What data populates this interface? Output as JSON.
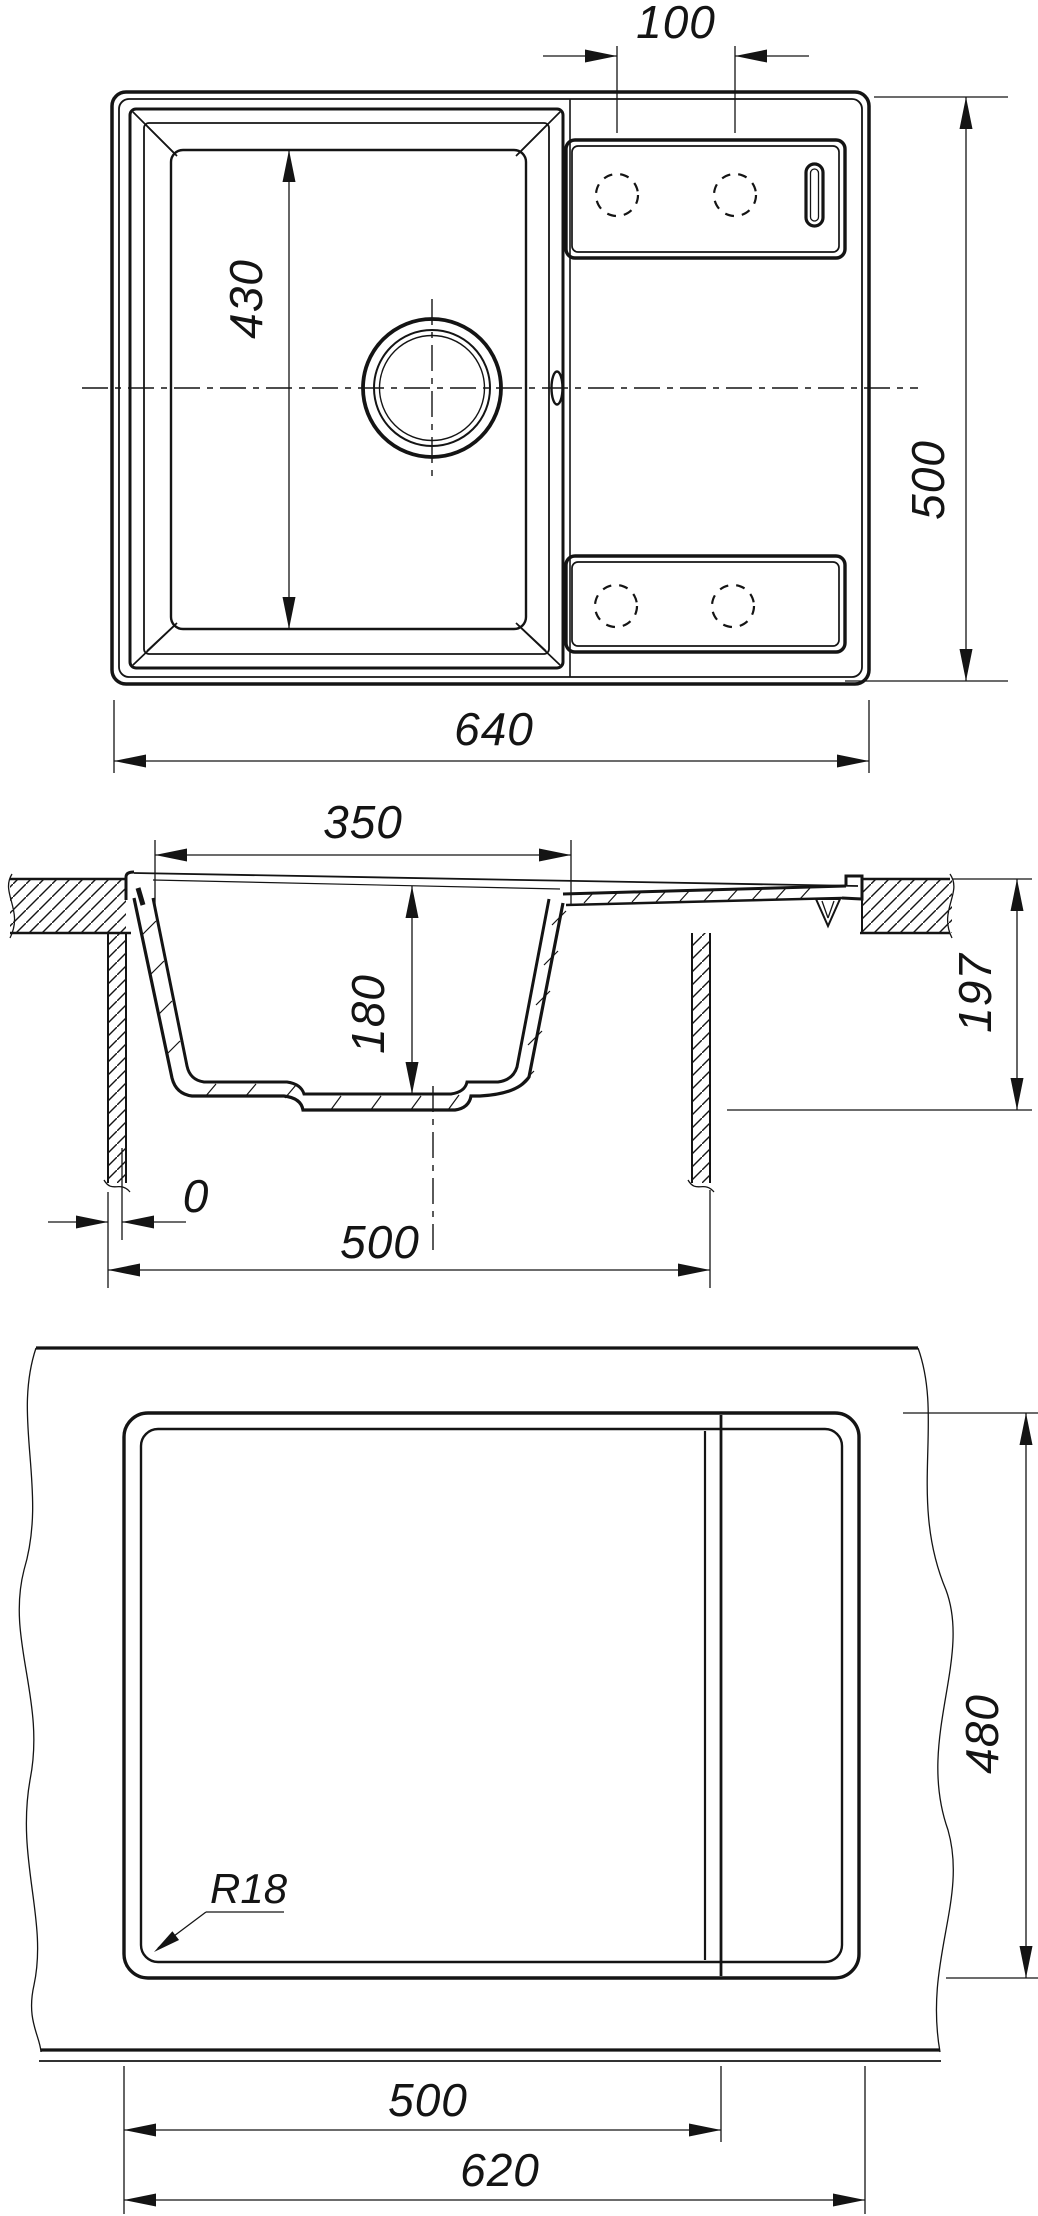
{
  "drawing": {
    "type": "technical-drawing",
    "subject": "kitchen sink with drainboard - dimensional drawing",
    "line_color": "#141414",
    "background": "#ffffff",
    "views": {
      "top": {
        "title": "top view",
        "dims": {
          "faucet_hole_spacing": "100",
          "overall_width": "640",
          "overall_depth": "500",
          "bowl_length": "430"
        }
      },
      "section": {
        "title": "cross section",
        "dims": {
          "bowl_top_width": "350",
          "bowl_depth": "180",
          "under_counter_depth": "197",
          "edge_offset": "0",
          "cabinet_min_width": "500"
        }
      },
      "cutout": {
        "title": "countertop cutout view",
        "dims": {
          "cutout_width": "500",
          "overall_width": "620",
          "overall_depth": "480",
          "corner_radius": "R18"
        }
      }
    }
  }
}
